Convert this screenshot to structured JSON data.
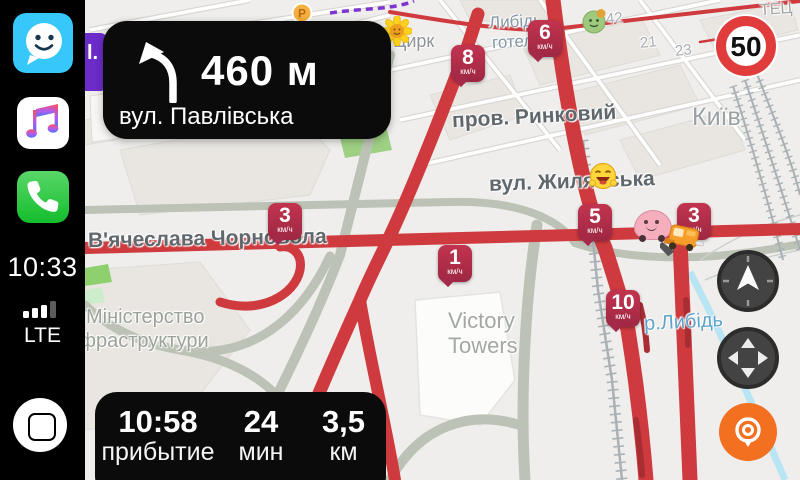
{
  "statusbar": {
    "time": "10:33",
    "network": "LTE"
  },
  "navigation": {
    "distance": "460 м",
    "street": "вул. Павлівська",
    "maneuver_icon": "turn-left-curve-icon"
  },
  "eta": {
    "arrival_time": "10:58",
    "arrival_label": "прибытие",
    "duration_value": "24",
    "duration_label": "мин",
    "distance_value": "3,5",
    "distance_label": "км"
  },
  "speed_limit": "50",
  "map": {
    "partial_banner_text": "l.",
    "badge_unit": "км/ч",
    "speed_badges": [
      {
        "value": "8",
        "unit": "км/ч",
        "x": 451,
        "y": 45
      },
      {
        "value": "6",
        "unit": "км/ч",
        "x": 528,
        "y": 20
      },
      {
        "value": "3",
        "unit": "км/ч",
        "x": 268,
        "y": 203
      },
      {
        "value": "5",
        "unit": "км/ч",
        "x": 578,
        "y": 204
      },
      {
        "value": "3",
        "unit": "км/ч",
        "x": 677,
        "y": 203
      },
      {
        "value": "1",
        "unit": "км/ч",
        "x": 438,
        "y": 245
      },
      {
        "value": "10",
        "unit": "км/ч",
        "x": 606,
        "y": 290
      }
    ],
    "labels": [
      {
        "text": "ТЕЦ",
        "x": 760,
        "y": 1,
        "fs": 16,
        "color": "#9fa5a7",
        "rot": -4
      },
      {
        "text": "Либідь",
        "x": 489,
        "y": 12,
        "fs": 17,
        "color": "#8595a3",
        "rot": -3
      },
      {
        "text": "готель",
        "x": 492,
        "y": 32,
        "fs": 17,
        "color": "#8595a3",
        "rot": -3
      },
      {
        "text": "Цирк",
        "x": 393,
        "y": 31,
        "fs": 18,
        "color": "#8d9398",
        "rot": 0
      },
      {
        "text": "42",
        "x": 606,
        "y": 10,
        "fs": 15,
        "color": "#a9aeb1",
        "rot": -6
      },
      {
        "text": "21",
        "x": 640,
        "y": 34,
        "fs": 15,
        "color": "#a9aeb1",
        "rot": -6
      },
      {
        "text": "23",
        "x": 675,
        "y": 42,
        "fs": 15,
        "color": "#a9aeb1",
        "rot": -6
      },
      {
        "text": "пров. Ринковий",
        "x": 452,
        "y": 105,
        "fs": 21,
        "color": "#60686d",
        "rot": -3,
        "bold": true
      },
      {
        "text": "Київ",
        "x": 692,
        "y": 103,
        "fs": 25,
        "color": "#9aa0a3",
        "rot": 0
      },
      {
        "text": "вул. Жилянська",
        "x": 489,
        "y": 170,
        "fs": 21,
        "color": "#60686d",
        "rot": -2,
        "bold": true
      },
      {
        "text": "В'ячеслава Чорновола",
        "x": 88,
        "y": 227,
        "fs": 21,
        "color": "#60686d",
        "rot": -1,
        "bold": true
      },
      {
        "text": "Міністерство",
        "x": 86,
        "y": 306,
        "fs": 20,
        "color": "#9ba29a",
        "rot": 0
      },
      {
        "text": "інфраструктури",
        "x": 64,
        "y": 330,
        "fs": 20,
        "color": "#9ba29a",
        "rot": 0
      },
      {
        "text": "Victory",
        "x": 448,
        "y": 308,
        "fs": 22,
        "color": "#a2a8a0",
        "rot": 0
      },
      {
        "text": "Towers",
        "x": 448,
        "y": 333,
        "fs": 22,
        "color": "#a2a8a0",
        "rot": 0
      },
      {
        "text": "р.Либідь",
        "x": 644,
        "y": 311,
        "fs": 20,
        "color": "#5ea3c9",
        "rot": -3
      }
    ],
    "colors": {
      "background": "#efeeec",
      "traffic_red": "#cf3a3e",
      "badge_red": "#b02c4b",
      "sage_road": "#bcc3b6",
      "river_blue": "#b8e4f4",
      "route_purple": "#7c35cf"
    }
  },
  "icons": {
    "waze_app": "waze smiley bubble",
    "music_app": "double music note",
    "phone_app": "telephone handset",
    "home": "circle with rounded square",
    "compass": "north arrow dial",
    "pan": "four-way arrows",
    "locate": "waze location pin",
    "speed_limit_sign": "red ring 50",
    "characters": [
      "parking-coin",
      "sunflower-mood",
      "green-face-mood",
      "laughing-mood",
      "pink-wazer-ghost",
      "construction-truck"
    ]
  }
}
